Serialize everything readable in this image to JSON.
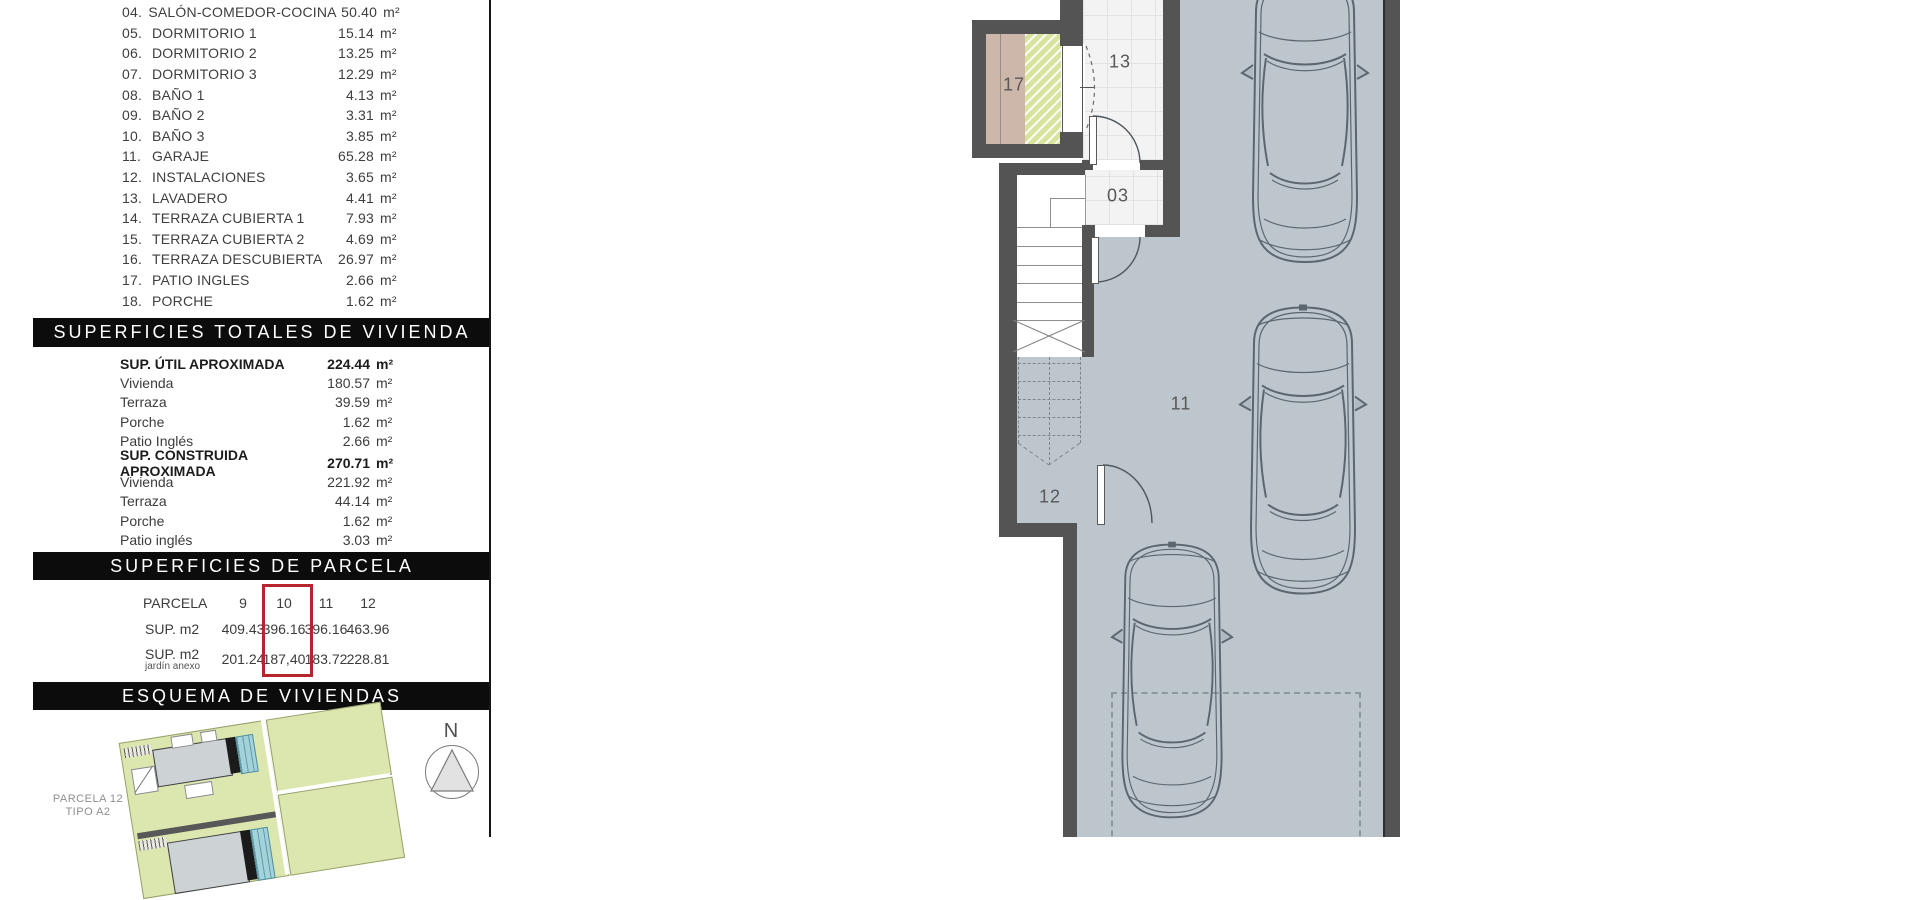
{
  "units": {
    "m2": "m²"
  },
  "left_panel": {
    "room_list": [
      {
        "n": "04.",
        "name": "SALÓN-COMEDOR-COCINA",
        "area": "50.40"
      },
      {
        "n": "05.",
        "name": "DORMITORIO 1",
        "area": "15.14"
      },
      {
        "n": "06.",
        "name": "DORMITORIO 2",
        "area": "13.25"
      },
      {
        "n": "07.",
        "name": "DORMITORIO 3",
        "area": "12.29"
      },
      {
        "n": "08.",
        "name": "BAÑO 1",
        "area": "4.13"
      },
      {
        "n": "09.",
        "name": "BAÑO 2",
        "area": "3.31"
      },
      {
        "n": "10.",
        "name": "BAÑO 3",
        "area": "3.85"
      },
      {
        "n": "11.",
        "name": "GARAJE",
        "area": "65.28"
      },
      {
        "n": "12.",
        "name": "INSTALACIONES",
        "area": "3.65"
      },
      {
        "n": "13.",
        "name": "LAVADERO",
        "area": "4.41"
      },
      {
        "n": "14.",
        "name": "TERRAZA CUBIERTA 1",
        "area": "7.93"
      },
      {
        "n": "15.",
        "name": "TERRAZA CUBIERTA 2",
        "area": "4.69"
      },
      {
        "n": "16.",
        "name": "TERRAZA DESCUBIERTA",
        "area": "26.97"
      },
      {
        "n": "17.",
        "name": "PATIO INGLES",
        "area": "2.66"
      },
      {
        "n": "18.",
        "name": "PORCHE",
        "area": "1.62"
      }
    ],
    "totals": {
      "header": "SUPERFICIES TOTALES DE VIVIENDA",
      "util": {
        "label": "SUP. ÚTIL APROXIMADA",
        "value": "224.44",
        "rows": [
          {
            "label": "Vivienda",
            "value": "180.57"
          },
          {
            "label": "Terraza",
            "value": "39.59"
          },
          {
            "label": "Porche",
            "value": "1.62"
          },
          {
            "label": "Patio Inglés",
            "value": "2.66"
          }
        ]
      },
      "construida": {
        "label": "SUP. CONSTRUIDA APROXIMADA",
        "value": "270.71",
        "rows": [
          {
            "label": "Vivienda",
            "value": "221.92"
          },
          {
            "label": "Terraza",
            "value": "44.14"
          },
          {
            "label": "Porche",
            "value": "1.62"
          },
          {
            "label": "Patio inglés",
            "value": "3.03"
          }
        ]
      }
    },
    "parcela": {
      "header": "SUPERFICIES DE PARCELA",
      "col_header": "PARCELA",
      "columns": [
        "9",
        "10",
        "11",
        "12"
      ],
      "highlighted_column": "10",
      "row1": {
        "label": "SUP. m2",
        "values": [
          "409.43",
          "396.16",
          "396.16",
          "463.96"
        ]
      },
      "row2": {
        "label": "SUP. m2",
        "sublabel": "jardín anexo",
        "values": [
          "201.24",
          "187,40",
          "183.72",
          "228.81"
        ]
      }
    },
    "esquema": {
      "header": "ESQUEMA DE VIVIENDAS",
      "caption_line1": "PARCELA 12",
      "caption_line2": "TIPO A2",
      "north_label": "N"
    }
  },
  "floor_plan": {
    "labels": {
      "patio": "17",
      "lavadero": "13",
      "hall": "03",
      "garaje": "11",
      "instalaciones": "12"
    }
  },
  "colors": {
    "highlight_red": "#b5252b",
    "garage_floor": "#bcc6cc",
    "wall_gray": "#545454",
    "patio_tan": "#cdb6aa",
    "hatch_green": "#d8e49e",
    "siteplan_green": "#dbe7ae",
    "pool_teal": "#a3d2db",
    "bar_black": "#0c0c0c"
  }
}
